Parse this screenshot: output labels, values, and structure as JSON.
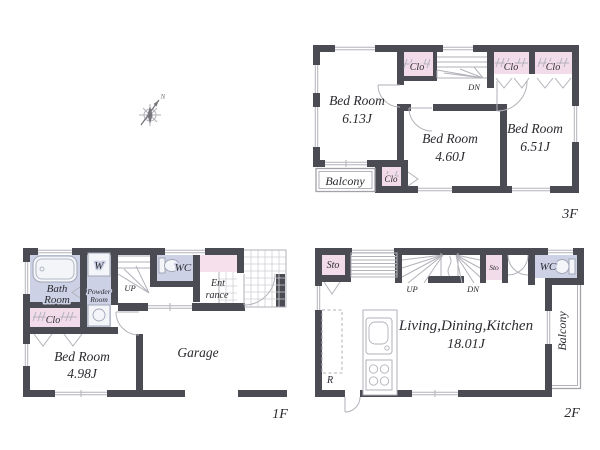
{
  "colors": {
    "wall": "#4b4b53",
    "closet_fill": "#f3dcea",
    "wet_area_fill": "#ccd1e5",
    "entrance_closet_fill": "#f6e0ec",
    "line": "#b2b2ba",
    "text": "#2a2a30",
    "background": "#ffffff"
  },
  "compass": {
    "north": "N"
  },
  "floor3": {
    "label": "3F",
    "bedroom1": {
      "name": "Bed Room",
      "area": "6.13J"
    },
    "bedroom2": {
      "name": "Bed Room",
      "area": "4.60J"
    },
    "bedroom3": {
      "name": "Bed Room",
      "area": "6.51J"
    },
    "balcony": "Balcony",
    "closet_top": "Clo",
    "closet_right1": "Clo",
    "closet_right2": "Clo",
    "closet_balcony": "Clo",
    "stairs_down": "DN"
  },
  "floor1": {
    "label": "1F",
    "bathroom": {
      "line1": "Bath",
      "line2": "Room"
    },
    "washer": "W",
    "powder_room": {
      "line1": "Powder",
      "line2": "Room"
    },
    "toilet": "WC",
    "closet": "Clo",
    "entrance": {
      "line1": "Ent",
      "line2": "rance"
    },
    "bedroom": {
      "name": "Bed Room",
      "area": "4.98J"
    },
    "garage": "Garage",
    "stairs_up": "UP"
  },
  "floor2": {
    "label": "2F",
    "storage_left": "Sto",
    "storage_small": "Sto",
    "toilet": "WC",
    "ldk": {
      "name": "Living,Dining,Kitchen",
      "area": "18.01J"
    },
    "balcony": "Balcony",
    "refrigerator": "R",
    "stairs_up": "UP",
    "stairs_down": "DN"
  }
}
